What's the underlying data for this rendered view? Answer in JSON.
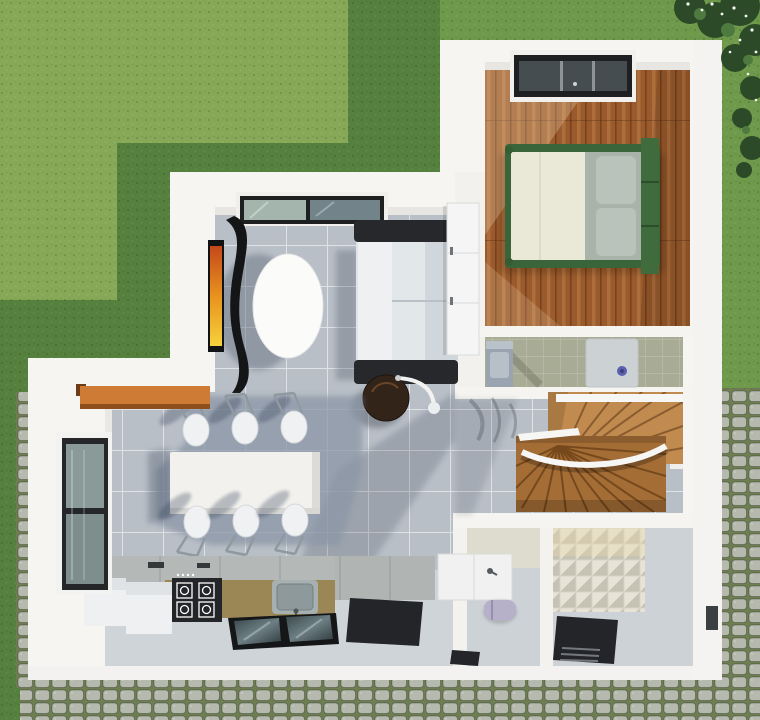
{
  "scene": {
    "type": "architectural-3d-floorplan-top-view",
    "setting": {
      "yard": [
        "lawn-light-sunlit",
        "lawn-shadowed",
        "cobblestone-sett-paths",
        "flowering-shrub-top-right"
      ],
      "lighting": "sunlight from upper-right, soft cast shadows toward lower-left"
    },
    "rooms": [
      {
        "name": "living-room",
        "floor": "gray-ceramic-tile",
        "items": [
          "picture-window",
          "wall-tv",
          "curved-tv-panel",
          "oval-side-table",
          "three-seat-sofa",
          "round-coffee-table",
          "arc-floor-lamp",
          "wardrobe"
        ]
      },
      {
        "name": "dining-area",
        "floor": "gray-ceramic-tile",
        "items": [
          "dining-table",
          "six-chairs",
          "breakfast-bar"
        ]
      },
      {
        "name": "kitchen",
        "floor": "light-concrete",
        "items": [
          "base-cabinets",
          "olive-counter",
          "gas-hob",
          "sink",
          "refrigerator",
          "appliance",
          "glass-floor-panel",
          "window",
          "floor-mat"
        ]
      },
      {
        "name": "bedroom",
        "floor": "hardwood-planks",
        "items": [
          "double-bed-green-frame",
          "pillows",
          "roof-window"
        ]
      },
      {
        "name": "bathroom-upper",
        "floor": "sage-tile",
        "items": [
          "washbasin-cabinet",
          "shower-tray",
          "blue-drain"
        ]
      },
      {
        "name": "staircase",
        "items": [
          "winder-stairs-two-flights",
          "white-handrail",
          "landing"
        ]
      },
      {
        "name": "hallway",
        "floor": "gray-ceramic-tile",
        "items": [
          "branch-shadows"
        ]
      },
      {
        "name": "wc-corridor",
        "items": [
          "vanity-counter",
          "toilet",
          "doormat",
          "threshold"
        ]
      },
      {
        "name": "bathroom-lower",
        "items": [
          "3d-panel-feature-wall",
          "black-shower-mat"
        ]
      }
    ]
  },
  "palette": {
    "grass_light": "#87a957",
    "grass_shadow": "#55803e",
    "grass_mid": "#6f9a4b",
    "bush_dark": "#2c4a27",
    "cobble_base": "#6e7e52",
    "wall_white": "#f6f5f2",
    "tile_gray": "#b9bfc7",
    "kitchen_floor": "#cfd4d8",
    "wood_floor": "#9a5a2b",
    "stair_upper": "#c18a4e",
    "stair_lower": "#a46d36",
    "bath_floor": "#a8ac94",
    "corridor_floor": "#cdd2d6",
    "panel_wall": "#d7d3c6",
    "counter_olive": "#9b8656",
    "black": "#232528",
    "orange_bar": "#cd7b35",
    "sofa_seat": "#eef0f1",
    "sofa_back": "#cfd6dc",
    "bed_green": "#3a653a",
    "bed_cream": "#eae8d7",
    "bed_gray": "#a9b3aa",
    "toilet_lavender": "#b6b0c9",
    "appliance_white": "#eef0f1",
    "table_white": "#f2f1ed",
    "oval_white": "#fbfbfa"
  }
}
